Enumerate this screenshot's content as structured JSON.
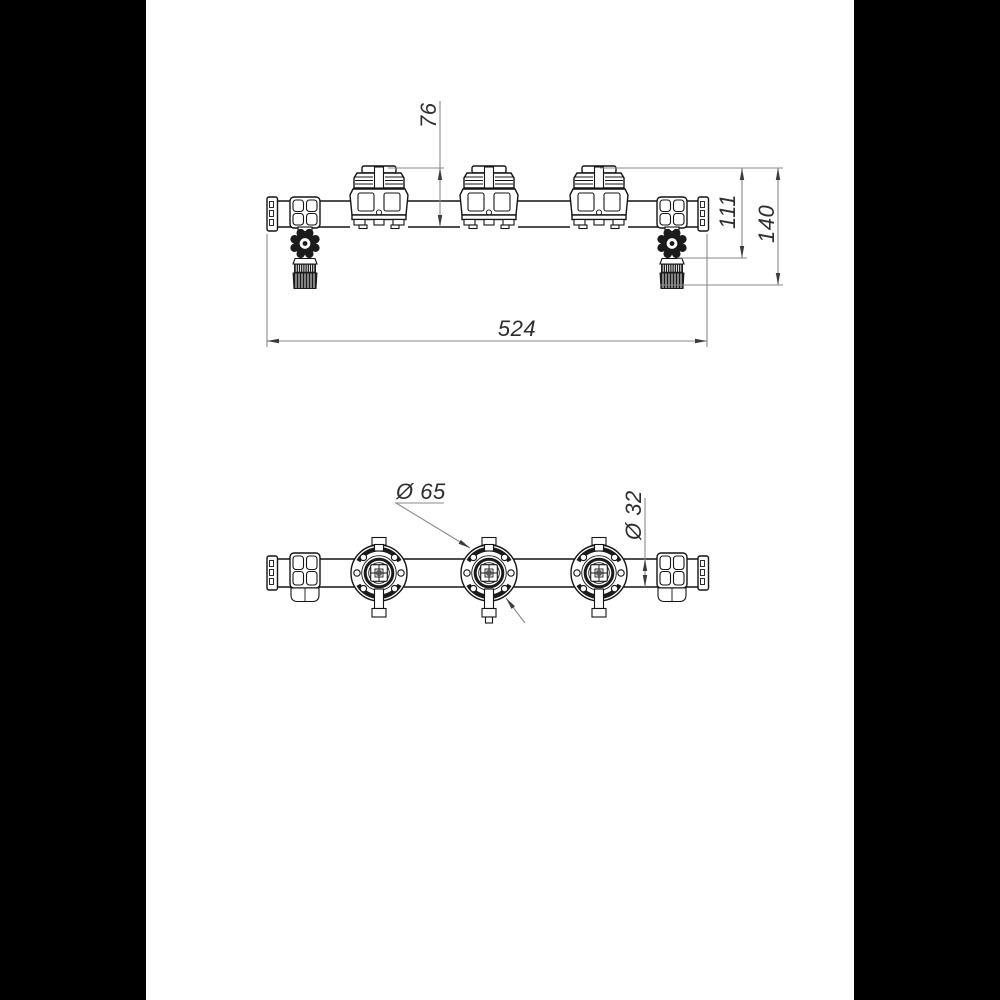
{
  "drawing": {
    "type": "technical-drawing-manifold-two-views",
    "dimension_labels": {
      "valve_height": "76",
      "height_to_handwheel": "111",
      "overall_height": "140",
      "overall_length": "524",
      "valve_flange_diameter": "Ø 65",
      "pipe_diameter": "Ø 32"
    },
    "colors": {
      "letterbox": "#000000",
      "sheet": "#ffffff",
      "part_outline": "#141414",
      "dimension_lines": "#8a8a8a",
      "dimension_text": "#2e2e2e"
    }
  }
}
